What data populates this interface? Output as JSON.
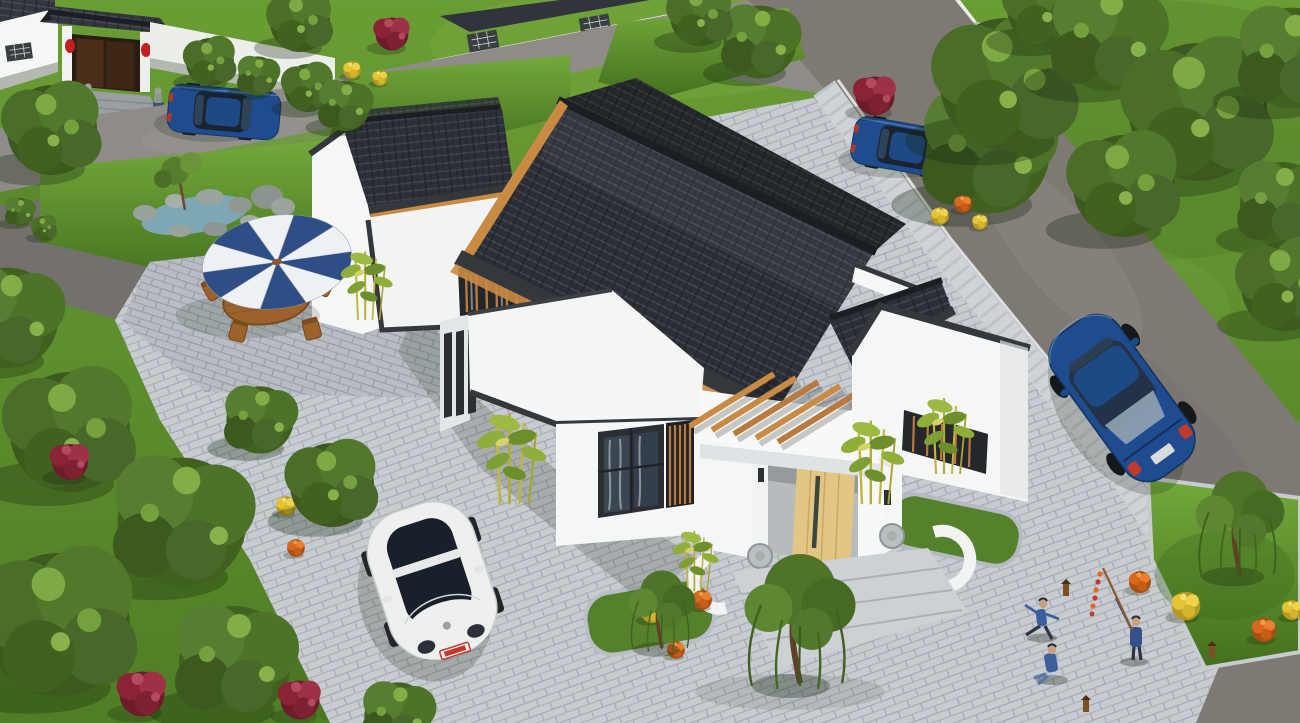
{
  "scene": {
    "type": "aerial-3d-architectural-render",
    "description": "Bird's-eye rendering of a single-storey Chinese-style courtyard residence with charcoal tiled roofs and white walls, surrounded by paver courtyards, lawns, mature trees, parked cars, a patio parasol set, a rock-garden pond and figures playing with firecrackers on a plaza.",
    "palette": {
      "grass": "#5f8f2c",
      "grass_shade": "#41671d",
      "road": "#8f8c88",
      "road_right": "#7e7973",
      "driveway": "#74716d",
      "paver": "#c7ccd1",
      "paver_joint": "#a6acb3",
      "paver_patio": "#b7bdc3",
      "sidewalk": "#cfd3d7",
      "curb": "#dcdedf",
      "roof_tile": "#2c3036",
      "roof_tile_light": "#474d56",
      "roof_ridge": "#1b1e23",
      "trim": "#34373c",
      "wall": "#f5f6f6",
      "wall_shade": "#e2e6e7",
      "wall_dark": "#c9cfd2",
      "wood": "#c98b43",
      "door": "#e3c584",
      "steps": "#cdd1d5",
      "water": "#7ea7b5",
      "rock": "#98a19b",
      "umbrella_blue": "#2e4e86",
      "umbrella_white": "#edf0f5",
      "furniture_wood": "#9c622c",
      "car_blue": "#1e4c8e",
      "car_glass": "#18202b",
      "car_white": "#eef0ee",
      "flower_red": "#8b2336",
      "flower_orange": "#d8671f",
      "flower_yellow": "#e2c437",
      "tree_green": "#47682a",
      "tree_light": "#7fa944",
      "bamboo": "#b9c24a",
      "skin": "#c9a183",
      "clothes_blue": "#3a5f9a",
      "lantern_red": "#c42020",
      "gate_door": "#4a2e1a"
    },
    "objects": [
      {
        "name": "main-courtyard-house",
        "details": "single-storey Chinese-style house: white stucco walls, charcoal tile gabled roofs with dark ridge caps, stepped horse-head gable, flat white parapet roofs, timber pergola beams, central entrance with light timber door, stone drums and granite steps"
      },
      {
        "name": "neighbor-gatehouse",
        "details": "traditional entry gate with grey tile roof, brown double doors, red lanterns and stone lions, blue sedan parked in front"
      },
      {
        "name": "patio-set",
        "details": "blue and white striped parasol over an oval wooden table with four wooden folding chairs"
      },
      {
        "name": "rock-garden",
        "details": "small pond ringed by grey rocks with a small ornamental tree on the lawn"
      },
      {
        "name": "vehicles",
        "details": "white VW Beetle parked on the courtyard pavers; blue sedans parked by the gate, on the upper road and on the east road"
      },
      {
        "name": "figures",
        "details": "two children and an adult raising a stick with a string of firecrackers on the south-east plaza"
      },
      {
        "name": "planting",
        "details": "mature green shade trees, red-leaf shrubs, yellow and orange flower bushes, bamboo clumps beside the house, weeping willows"
      }
    ]
  }
}
